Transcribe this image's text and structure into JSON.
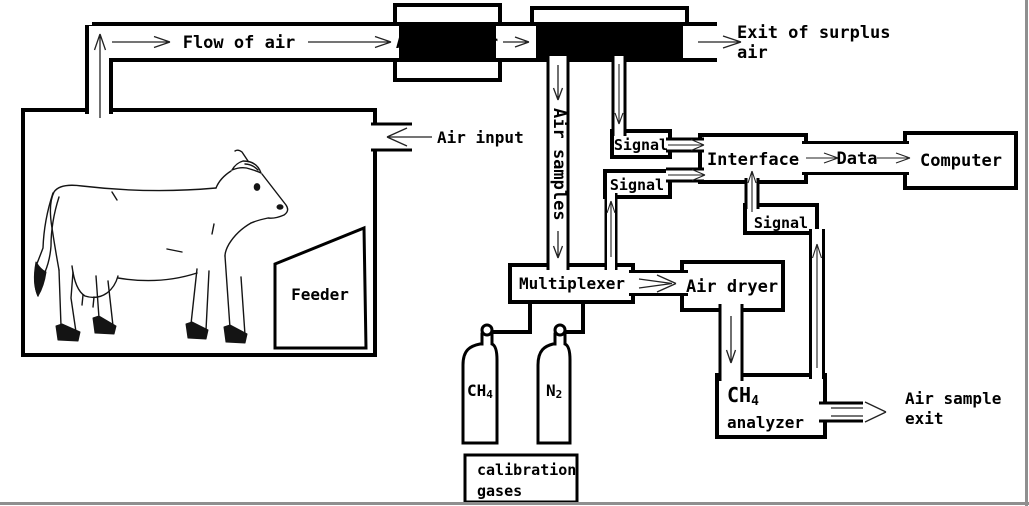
{
  "labels": {
    "flow_of_air": "Flow of air",
    "air_filter": "Air filter",
    "mass_flowmeter": "Mass flowmeter",
    "exit_surplus_1": "Exit of surplus",
    "exit_surplus_2": "air",
    "air_input": "Air input",
    "air_samples": "Air samples",
    "signal_1": "Signal",
    "signal_2": "Signal",
    "signal_3": "Signal",
    "interface": "Interface",
    "data": "Data",
    "computer": "Computer",
    "multiplexer": "Multiplexer",
    "air_dryer": "Air dryer",
    "analyzer_formula": "CH",
    "analyzer_formula_sub": "4",
    "analyzer_word": "analyzer",
    "air_sample_exit_1": "Air sample",
    "air_sample_exit_2": "exit",
    "feeder": "Feeder",
    "cylinder_ch4": "CH",
    "cylinder_ch4_sub": "4",
    "cylinder_n2": "N",
    "cylinder_n2_sub": "2",
    "calibration_1": "calibration",
    "calibration_2": "gases"
  },
  "colors": {
    "line": "#000000",
    "arrow": "#222222",
    "background": "#ffffff",
    "frame_edge": "#8f8f8f"
  }
}
